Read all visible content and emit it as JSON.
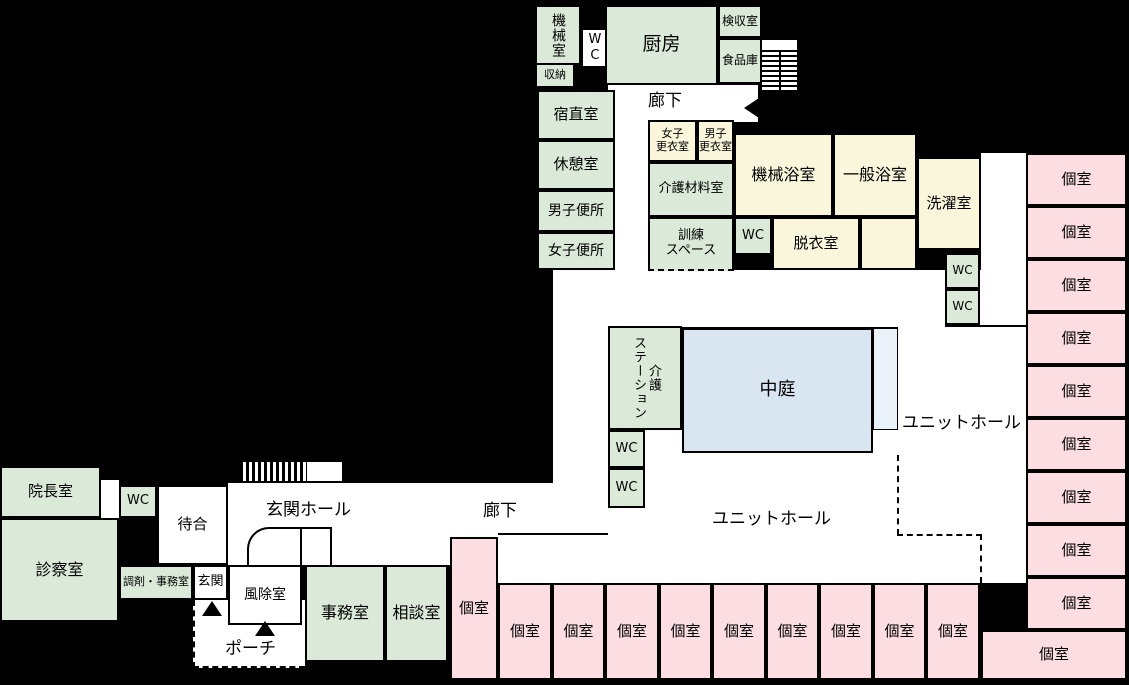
{
  "title": "施設平面図",
  "colors": {
    "room_green": "#dbe9d8",
    "room_cream": "#faf6dc",
    "room_pink": "#fbdde2",
    "courtyard_blue": "#d9e6f2",
    "courtyard_light": "#eaf2f9",
    "floor_white": "#ffffff",
    "background": "#000000",
    "wall": "#000000"
  },
  "floors": [
    {
      "x": 608,
      "y": 85,
      "w": 150,
      "h": 37
    },
    {
      "x": 615,
      "y": 120,
      "w": 33,
      "h": 152
    },
    {
      "x": 553,
      "y": 270,
      "w": 428,
      "h": 57
    },
    {
      "x": 553,
      "y": 327,
      "w": 55,
      "h": 208
    },
    {
      "x": 981,
      "y": 153,
      "w": 45,
      "h": 174
    },
    {
      "x": 898,
      "y": 327,
      "w": 128,
      "h": 256
    },
    {
      "x": 608,
      "y": 453,
      "w": 290,
      "h": 130
    },
    {
      "x": 608,
      "y": 508,
      "w": 37,
      "h": 75
    },
    {
      "x": 645,
      "y": 430,
      "w": 37,
      "h": 25
    },
    {
      "x": 873,
      "y": 430,
      "w": 25,
      "h": 23
    },
    {
      "x": 228,
      "y": 483,
      "w": 380,
      "h": 52
    },
    {
      "x": 228,
      "y": 535,
      "w": 222,
      "h": 30
    },
    {
      "x": 450,
      "y": 535,
      "w": 158,
      "h": 48
    },
    {
      "x": 101,
      "y": 480,
      "w": 18,
      "h": 38
    },
    {
      "x": 762,
      "y": 40,
      "w": 35,
      "h": 50
    },
    {
      "x": 307,
      "y": 462,
      "w": 35,
      "h": 19
    }
  ],
  "porch": {
    "x": 193,
    "y": 600,
    "w": 112,
    "h": 68
  },
  "rooms": [
    {
      "label": "機械室",
      "x": 535,
      "y": 5,
      "w": 46,
      "h": 60,
      "fill": "room_green",
      "vert": true,
      "f": 14
    },
    {
      "label": "WC",
      "x": 581,
      "y": 28,
      "w": 26,
      "h": 40,
      "fill": "floor_white",
      "vert": true,
      "f": 13
    },
    {
      "label": "収納",
      "x": 535,
      "y": 63,
      "w": 40,
      "h": 25,
      "fill": "room_green",
      "f": 11
    },
    {
      "label": "厨房",
      "x": 605,
      "y": 5,
      "w": 113,
      "h": 80,
      "fill": "room_green",
      "f": 19
    },
    {
      "label": "検収室",
      "x": 718,
      "y": 5,
      "w": 44,
      "h": 33,
      "fill": "room_green",
      "f": 12
    },
    {
      "label": "食品庫",
      "x": 718,
      "y": 38,
      "w": 44,
      "h": 46,
      "fill": "room_green",
      "f": 12
    },
    {
      "label": "宿直室",
      "x": 537,
      "y": 90,
      "w": 78,
      "h": 50,
      "fill": "room_green",
      "f": 15
    },
    {
      "label": "休憩室",
      "x": 537,
      "y": 140,
      "w": 78,
      "h": 50,
      "fill": "room_green",
      "f": 15
    },
    {
      "label": "男子便所",
      "x": 537,
      "y": 190,
      "w": 78,
      "h": 42,
      "fill": "room_green",
      "f": 14
    },
    {
      "label": "女子便所",
      "x": 537,
      "y": 232,
      "w": 78,
      "h": 38,
      "fill": "room_green",
      "f": 14
    },
    {
      "label": "女子\n更衣室",
      "x": 648,
      "y": 120,
      "w": 49,
      "h": 42,
      "fill": "room_cream",
      "f": 11
    },
    {
      "label": "男子\n更衣室",
      "x": 697,
      "y": 120,
      "w": 37,
      "h": 42,
      "fill": "room_cream",
      "f": 11
    },
    {
      "label": "機械浴室",
      "x": 734,
      "y": 133,
      "w": 99,
      "h": 84,
      "fill": "room_cream",
      "f": 16
    },
    {
      "label": "一般浴室",
      "x": 833,
      "y": 133,
      "w": 84,
      "h": 84,
      "fill": "room_cream",
      "f": 16
    },
    {
      "label": "洗濯室",
      "x": 917,
      "y": 157,
      "w": 64,
      "h": 93,
      "fill": "room_cream",
      "f": 15
    },
    {
      "label": "介護材料室",
      "x": 648,
      "y": 162,
      "w": 86,
      "h": 55,
      "fill": "room_green",
      "f": 13
    },
    {
      "label": "訓練\nスペース",
      "x": 648,
      "y": 217,
      "w": 86,
      "h": 54,
      "fill": "room_green",
      "f": 13,
      "cls": "dashed-bottom"
    },
    {
      "label": "WC",
      "x": 734,
      "y": 217,
      "w": 38,
      "h": 38,
      "fill": "room_green",
      "f": 13
    },
    {
      "label": "脱衣室",
      "x": 772,
      "y": 217,
      "w": 88,
      "h": 53,
      "fill": "room_cream",
      "f": 15
    },
    {
      "label": "",
      "x": 860,
      "y": 217,
      "w": 57,
      "h": 53,
      "fill": "room_cream",
      "f": 13
    },
    {
      "label": "WC",
      "x": 945,
      "y": 253,
      "w": 35,
      "h": 36,
      "fill": "room_green",
      "f": 12
    },
    {
      "label": "WC",
      "x": 945,
      "y": 289,
      "w": 35,
      "h": 36,
      "fill": "room_green",
      "f": 12
    },
    {
      "label": "介護\nステーション",
      "x": 608,
      "y": 326,
      "w": 74,
      "h": 104,
      "fill": "room_green",
      "vert": true,
      "f": 13
    },
    {
      "label": "WC",
      "x": 608,
      "y": 430,
      "w": 37,
      "h": 38,
      "fill": "room_green",
      "f": 13
    },
    {
      "label": "WC",
      "x": 608,
      "y": 468,
      "w": 37,
      "h": 40,
      "fill": "room_green",
      "f": 13
    },
    {
      "label": "中庭",
      "x": 682,
      "y": 328,
      "w": 191,
      "h": 125,
      "fill": "courtyard_blue",
      "f": 18
    },
    {
      "label": "院長室",
      "x": 0,
      "y": 466,
      "w": 101,
      "h": 52,
      "fill": "room_green",
      "f": 15
    },
    {
      "label": "WC",
      "x": 119,
      "y": 485,
      "w": 38,
      "h": 33,
      "fill": "room_green",
      "f": 13
    },
    {
      "label": "診察室",
      "x": 0,
      "y": 518,
      "w": 119,
      "h": 104,
      "fill": "room_green",
      "f": 16
    },
    {
      "label": "調剤・事務室",
      "x": 119,
      "y": 565,
      "w": 74,
      "h": 35,
      "fill": "room_green",
      "f": 11
    },
    {
      "label": "待合",
      "x": 157,
      "y": 485,
      "w": 71,
      "h": 80,
      "fill": "floor_white",
      "f": 15
    },
    {
      "label": "玄関",
      "x": 193,
      "y": 565,
      "w": 35,
      "h": 35,
      "fill": "floor_white",
      "f": 13
    },
    {
      "label": "風除室",
      "x": 228,
      "y": 565,
      "w": 74,
      "h": 60,
      "fill": "floor_white",
      "f": 14
    },
    {
      "label": "事務室",
      "x": 305,
      "y": 565,
      "w": 80,
      "h": 97,
      "fill": "room_green",
      "f": 16
    },
    {
      "label": "相談室",
      "x": 385,
      "y": 565,
      "w": 63,
      "h": 97,
      "fill": "room_green",
      "f": 16
    },
    {
      "label": "個室",
      "x": 450,
      "y": 537,
      "w": 48,
      "h": 143,
      "fill": "room_pink",
      "f": 15
    },
    {
      "label": "個室",
      "x": 498,
      "y": 583,
      "w": 54,
      "h": 97,
      "fill": "room_pink",
      "f": 15
    },
    {
      "label": "個室",
      "x": 552,
      "y": 583,
      "w": 53,
      "h": 97,
      "fill": "room_pink",
      "f": 15
    },
    {
      "label": "個室",
      "x": 605,
      "y": 583,
      "w": 54,
      "h": 97,
      "fill": "room_pink",
      "f": 15
    },
    {
      "label": "個室",
      "x": 659,
      "y": 583,
      "w": 53,
      "h": 97,
      "fill": "room_pink",
      "f": 15
    },
    {
      "label": "個室",
      "x": 712,
      "y": 583,
      "w": 54,
      "h": 97,
      "fill": "room_pink",
      "f": 15
    },
    {
      "label": "個室",
      "x": 766,
      "y": 583,
      "w": 53,
      "h": 97,
      "fill": "room_pink",
      "f": 15
    },
    {
      "label": "個室",
      "x": 819,
      "y": 583,
      "w": 54,
      "h": 97,
      "fill": "room_pink",
      "f": 15
    },
    {
      "label": "個室",
      "x": 873,
      "y": 583,
      "w": 53,
      "h": 97,
      "fill": "room_pink",
      "f": 15
    },
    {
      "label": "個室",
      "x": 926,
      "y": 583,
      "w": 54,
      "h": 97,
      "fill": "room_pink",
      "f": 15
    },
    {
      "label": "個室",
      "x": 1026,
      "y": 153,
      "w": 101,
      "h": 53,
      "fill": "room_pink",
      "f": 15
    },
    {
      "label": "個室",
      "x": 1026,
      "y": 206,
      "w": 101,
      "h": 53,
      "fill": "room_pink",
      "f": 15
    },
    {
      "label": "個室",
      "x": 1026,
      "y": 259,
      "w": 101,
      "h": 53,
      "fill": "room_pink",
      "f": 15
    },
    {
      "label": "個室",
      "x": 1026,
      "y": 312,
      "w": 101,
      "h": 53,
      "fill": "room_pink",
      "f": 15
    },
    {
      "label": "個室",
      "x": 1026,
      "y": 365,
      "w": 101,
      "h": 53,
      "fill": "room_pink",
      "f": 15
    },
    {
      "label": "個室",
      "x": 1026,
      "y": 418,
      "w": 101,
      "h": 53,
      "fill": "room_pink",
      "f": 15
    },
    {
      "label": "個室",
      "x": 1026,
      "y": 471,
      "w": 101,
      "h": 53,
      "fill": "room_pink",
      "f": 15
    },
    {
      "label": "個室",
      "x": 1026,
      "y": 524,
      "w": 101,
      "h": 53,
      "fill": "room_pink",
      "f": 15
    },
    {
      "label": "個室",
      "x": 1026,
      "y": 577,
      "w": 101,
      "h": 53,
      "fill": "room_pink",
      "f": 15
    },
    {
      "label": "個室",
      "x": 981,
      "y": 630,
      "w": 146,
      "h": 50,
      "fill": "room_pink",
      "f": 15
    }
  ],
  "labels": [
    {
      "text": "廊下",
      "x": 648,
      "y": 86,
      "f": 17
    },
    {
      "text": "廊下",
      "x": 483,
      "y": 496,
      "f": 17
    },
    {
      "text": "玄関ホール",
      "x": 266,
      "y": 495,
      "f": 17
    },
    {
      "text": "ユニットホール",
      "x": 902,
      "y": 408,
      "f": 17
    },
    {
      "text": "ユニットホール",
      "x": 712,
      "y": 504,
      "f": 17
    },
    {
      "text": "ポーチ",
      "x": 225,
      "y": 634,
      "f": 17
    }
  ],
  "shapes": [
    {
      "name": "entrance-hatch",
      "type": "hatch",
      "x": 240,
      "y": 462,
      "w": 67,
      "h": 19
    },
    {
      "name": "hall-opening",
      "type": "white-rect",
      "x": 307,
      "y": 462,
      "w": 35,
      "h": 19
    },
    {
      "name": "stairs",
      "type": "stairs",
      "x": 762,
      "y": 50,
      "w": 35,
      "h": 40
    },
    {
      "name": "stairs-rail",
      "type": "wall-v",
      "x": 779,
      "y": 50,
      "w": 2,
      "h": 40
    },
    {
      "name": "corridor-notch",
      "type": "tri-left",
      "x": 744,
      "y": 96,
      "w": 18,
      "h": 24
    },
    {
      "name": "entrance-arrow-1",
      "type": "tri-up",
      "x": 202,
      "y": 601,
      "w": 20,
      "h": 15
    },
    {
      "name": "entrance-arrow-2",
      "type": "tri-up",
      "x": 255,
      "y": 621,
      "w": 20,
      "h": 15
    },
    {
      "name": "unit-boundary-v1",
      "type": "dash-v",
      "x": 897,
      "y": 455,
      "w": 2,
      "h": 80
    },
    {
      "name": "unit-boundary-h",
      "type": "dash-h",
      "x": 897,
      "y": 534,
      "w": 85,
      "h": 2
    },
    {
      "name": "unit-boundary-v2",
      "type": "dash-v",
      "x": 980,
      "y": 534,
      "w": 2,
      "h": 49
    },
    {
      "name": "corridor-wall",
      "type": "wall-h",
      "x": 498,
      "y": 533,
      "w": 110,
      "h": 2
    },
    {
      "name": "hall-wall",
      "type": "wall-h",
      "x": 945,
      "y": 325,
      "w": 81,
      "h": 2
    },
    {
      "name": "vestibule-curve-wall",
      "type": "curve-wall",
      "x": 247,
      "y": 527,
      "w": 55,
      "h": 38
    },
    {
      "name": "vestibule-wall-v",
      "type": "wall-v",
      "x": 330,
      "y": 527,
      "w": 2,
      "h": 38
    },
    {
      "name": "vestibule-wall-h",
      "type": "wall-h",
      "x": 302,
      "y": 527,
      "w": 30,
      "h": 2
    },
    {
      "name": "courtyard-veranda",
      "type": "light-strip",
      "x": 873,
      "y": 328,
      "w": 25,
      "h": 102
    }
  ]
}
